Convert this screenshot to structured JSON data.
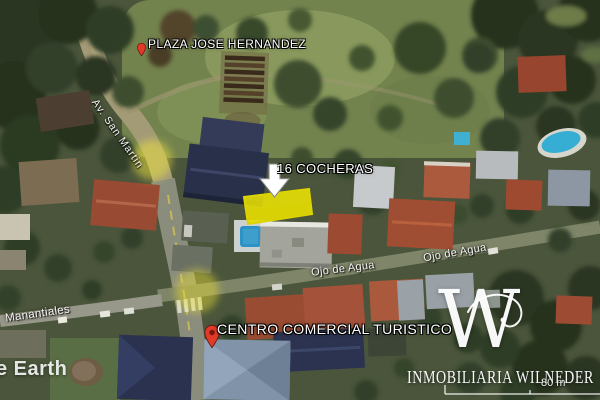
{
  "view": {
    "app_watermark_partial": "e Earth",
    "scale_label": "80 m"
  },
  "labels": {
    "plaza": "PLAZA JOSE HERNANDEZ",
    "property": "16 COCHERAS",
    "commercial_center": "CENTRO COMERCIAL TURISTICO",
    "street_ojo_left": "Ojo de Agua",
    "street_ojo_right": "Ojo de Agua",
    "street_manantiales": "Manantiales",
    "street_av_san_martin": "Av. San Martin"
  },
  "watermark": {
    "monogram": "W",
    "agency": "INMOBILIARIA WILNEDER"
  },
  "colors": {
    "parcel_highlight": "#f6ee00",
    "parcel_stroke": "#ddd400",
    "placemark_red": "#e03a28",
    "arrow_white": "#ffffff"
  }
}
